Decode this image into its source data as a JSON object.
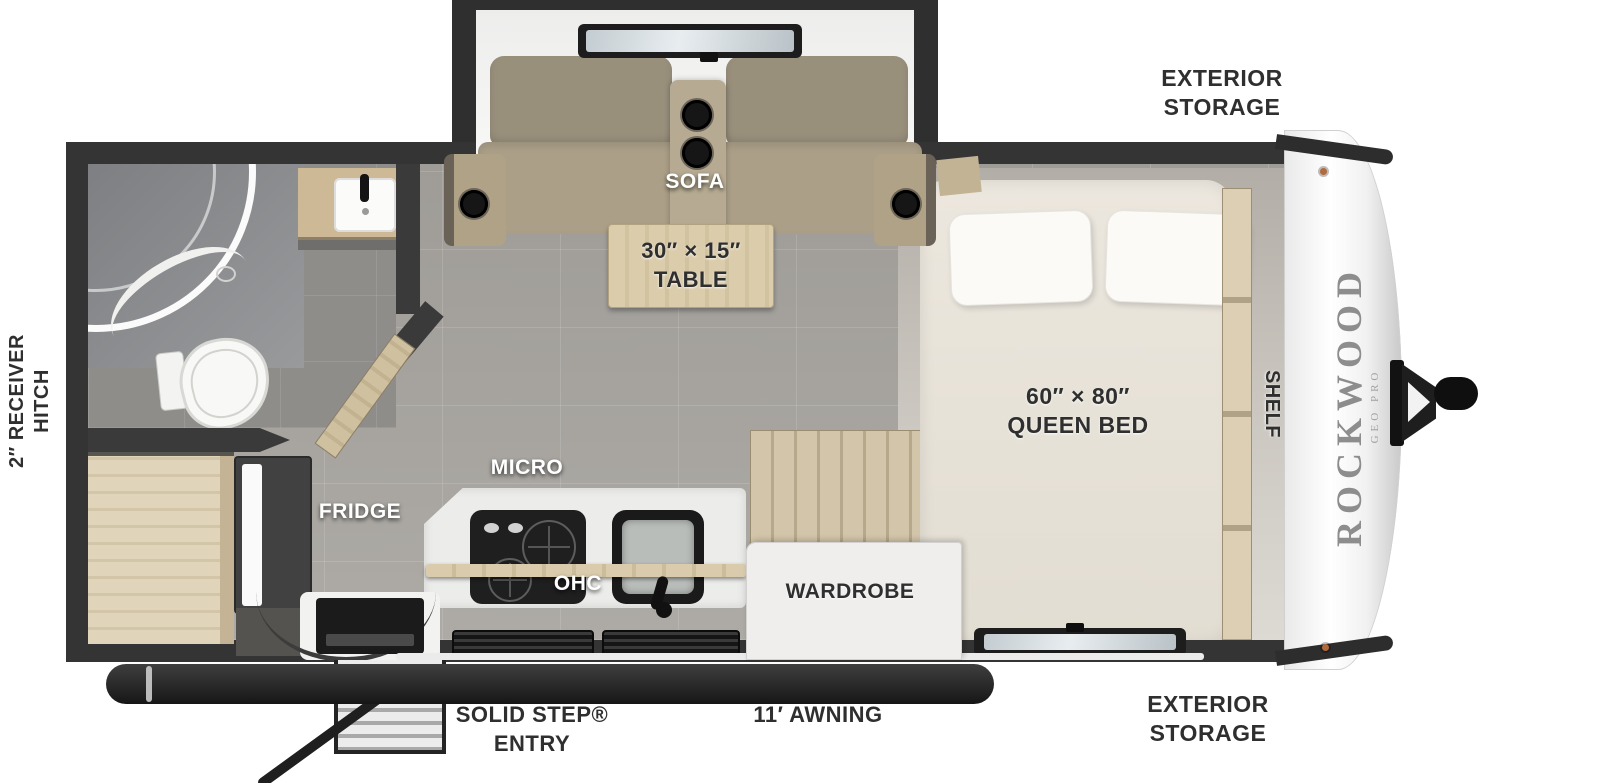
{
  "brand": {
    "name": "ROCKWOOD",
    "series": "GEO PRO"
  },
  "labels": {
    "exterior_storage_top": {
      "line1": "EXTERIOR",
      "line2": "STORAGE"
    },
    "exterior_storage_bottom": {
      "line1": "EXTERIOR",
      "line2": "STORAGE"
    },
    "sofa": "SOFA",
    "table": {
      "line1": "30″ × 15″",
      "line2": "TABLE"
    },
    "queen_bed": {
      "line1": "60″ × 80″",
      "line2": "QUEEN BED"
    },
    "shelf": "SHELF",
    "receiver_hitch": {
      "line1": "2″ RECEIVER",
      "line2": "HITCH"
    },
    "fridge": "FRIDGE",
    "micro": "MICRO",
    "ohc": "OHC",
    "wardrobe": "WARDROBE",
    "solid_step": {
      "line1": "SOLID STEP®",
      "line2": "ENTRY"
    },
    "awning": "11′ AWNING"
  },
  "colors": {
    "wall": "#343434",
    "floor": "#a9a6a1",
    "wood": "#d9caa9",
    "sofa": "#ab9f88",
    "bed": "#e9e4da",
    "counter": "#ececea",
    "front_cap": "#f4f4f4",
    "label_dark": "#2f2f2f",
    "label_light": "#ffffff",
    "window_glass": "#ccd4d8"
  }
}
